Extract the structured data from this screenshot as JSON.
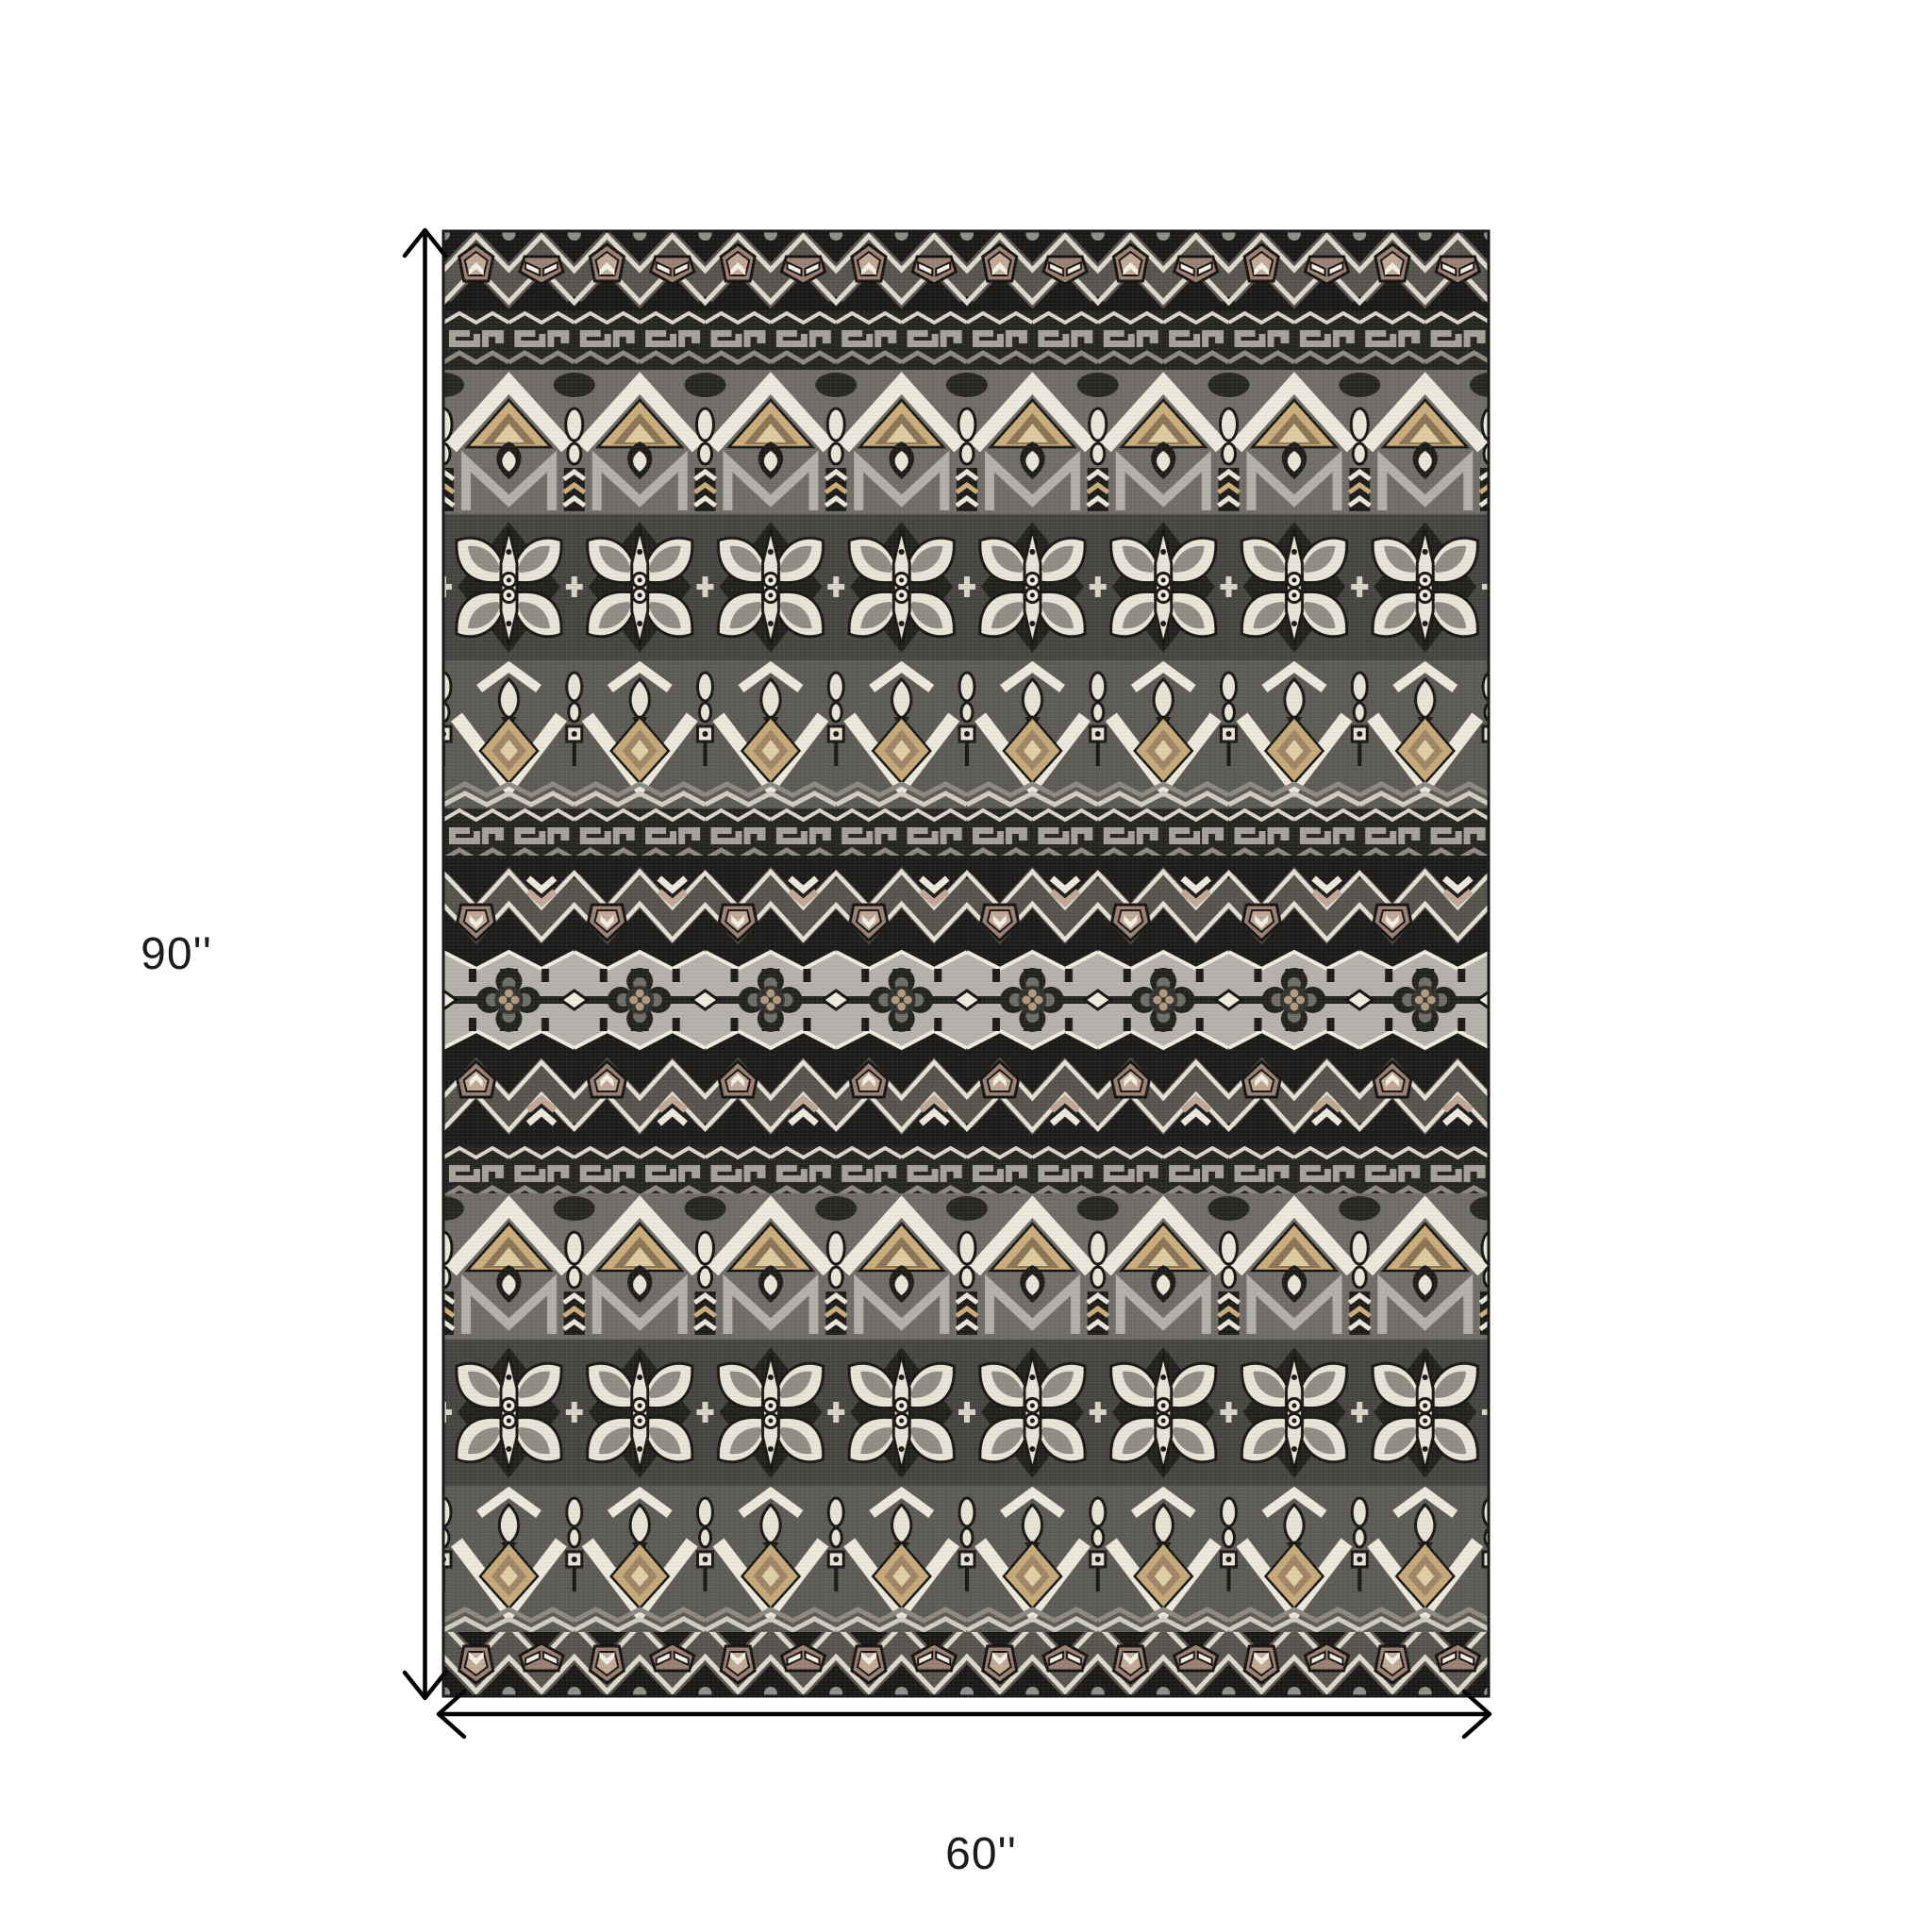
{
  "page": {
    "type": "product-dimension-diagram",
    "background_color": "#ffffff"
  },
  "dimensions": {
    "height": {
      "label": "90''",
      "value_inches": 90
    },
    "width": {
      "label": "60''",
      "value_inches": 60
    },
    "line_color": "#000000",
    "text_color": "#1c1c1c"
  },
  "product": {
    "name": "tribal-pattern-area-rug",
    "shape": "rectangle",
    "description": "Flatweave area rug with horizontal bands of tribal Aztec motifs in black, gray, cream, mauve and tan",
    "palette": {
      "black": "#181715",
      "charcoal": "#242320",
      "dark_gray": "#45433f",
      "gray": "#6e6b66",
      "silver": "#a4a19a",
      "light_gray": "#b4b1ab",
      "cream": "#e9e5d8",
      "white": "#f1eee2",
      "mauve": "#997f72",
      "light_mauve": "#c0a694",
      "tan": "#c9ac79",
      "khaki": "#ddca9f",
      "brown": "#8a7254"
    },
    "bands": [
      {
        "type": "pentagon-zigzag",
        "height": 85
      },
      {
        "type": "greek-key",
        "height": 62
      },
      {
        "type": "diamond-peaks",
        "height": 153
      },
      {
        "type": "butterfly-medallions",
        "height": 155
      },
      {
        "type": "drop-valleys",
        "height": 157
      },
      {
        "type": "greek-key-narrow",
        "height": 50
      },
      {
        "type": "shield-zigzag-down",
        "height": 96
      },
      {
        "type": "rosette-center",
        "height": 114
      },
      {
        "type": "shield-zigzag-up",
        "height": 98
      },
      {
        "type": "greek-key-narrow",
        "height": 50
      },
      {
        "type": "diamond-peaks",
        "height": 155
      },
      {
        "type": "butterfly-medallions",
        "height": 155
      },
      {
        "type": "drop-valleys",
        "height": 155
      },
      {
        "type": "pentagon-zigzag-bottom",
        "height": 68
      }
    ]
  }
}
